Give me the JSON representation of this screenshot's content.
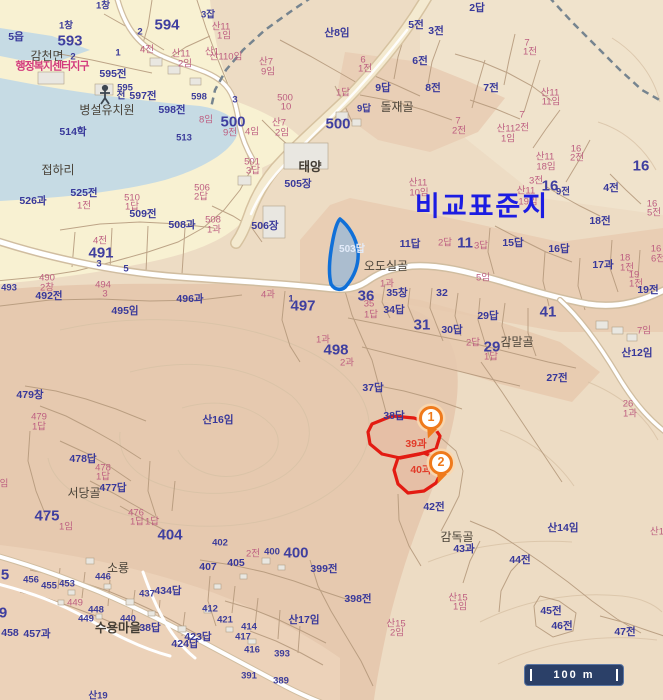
{
  "map": {
    "title_overlay": "비교표준지",
    "scale_bar": {
      "label": "100 m"
    },
    "markers": [
      {
        "label": "1",
        "x": 431,
        "y": 418
      },
      {
        "label": "2",
        "x": 441,
        "y": 463
      }
    ],
    "colors": {
      "highlight_parcel_stroke": "#1070d8",
      "selected_parcel_stroke": "#e31b12",
      "marker_accent": "#ef7a1c",
      "title_blue": "#1c1ce2",
      "urban_fill": "#f8f1d2",
      "water_fill": "#c6dbe4",
      "scalebar_fill": "#2b4068"
    },
    "icons": [
      {
        "name": "kindergarten-person-icon",
        "x": 105,
        "y": 91
      }
    ],
    "labels": [
      [
        "1창",
        103,
        6,
        "n"
      ],
      [
        "3잡",
        208,
        15,
        "n"
      ],
      [
        "594",
        167,
        25,
        "big"
      ],
      [
        "1창",
        66,
        26,
        "n"
      ],
      [
        "2",
        140,
        32,
        "n"
      ],
      [
        "5읍",
        16,
        37,
        "nb"
      ],
      [
        "593",
        70,
        41,
        "big"
      ],
      [
        "4전",
        147,
        50,
        "p"
      ],
      [
        "1",
        118,
        53,
        "n"
      ],
      [
        "산1",
        212,
        52,
        "p"
      ],
      [
        "감천면",
        47,
        56,
        "place"
      ],
      [
        "산11",
        181,
        54,
        "p"
      ],
      [
        "2임",
        185,
        64,
        "p"
      ],
      [
        "2",
        73,
        57,
        "n"
      ],
      [
        "행정복지센터지구",
        52,
        67,
        "adm"
      ],
      [
        "595전",
        113,
        74,
        "nb"
      ],
      [
        "595",
        125,
        88,
        "n"
      ],
      [
        "전",
        121,
        96,
        "n"
      ],
      [
        "597전",
        143,
        96,
        "nb"
      ],
      [
        "598",
        199,
        97,
        "n"
      ],
      [
        "598전",
        172,
        110,
        "nb"
      ],
      [
        "8임",
        206,
        120,
        "p"
      ],
      [
        "병설유치원",
        107,
        110,
        "place"
      ],
      [
        "514학",
        73,
        132,
        "nb"
      ],
      [
        "513",
        184,
        138,
        "n"
      ],
      [
        "접하리",
        58,
        170,
        "place"
      ],
      [
        "산11",
        221,
        27,
        "p"
      ],
      [
        "1임",
        224,
        36,
        "p"
      ],
      [
        "산110임",
        226,
        57,
        "p"
      ],
      [
        "산7",
        266,
        62,
        "p"
      ],
      [
        "9임",
        268,
        72,
        "p"
      ],
      [
        "산8임",
        337,
        33,
        "nb"
      ],
      [
        "5전",
        416,
        25,
        "nb"
      ],
      [
        "3전",
        436,
        31,
        "nb"
      ],
      [
        "6",
        363,
        60,
        "p"
      ],
      [
        "1전",
        365,
        69,
        "p"
      ],
      [
        "6전",
        420,
        61,
        "nb"
      ],
      [
        "8전",
        433,
        88,
        "nb"
      ],
      [
        "9답",
        383,
        88,
        "nb"
      ],
      [
        "1답",
        343,
        93,
        "p"
      ],
      [
        "9답",
        364,
        109,
        "n"
      ],
      [
        "돌재골",
        397,
        107,
        "place"
      ],
      [
        "500",
        285,
        98,
        "p"
      ],
      [
        "10",
        286,
        107,
        "p"
      ],
      [
        "3",
        235,
        100,
        "n"
      ],
      [
        "500",
        233,
        122,
        "big"
      ],
      [
        "9전",
        230,
        133,
        "p"
      ],
      [
        "4임",
        252,
        132,
        "p"
      ],
      [
        "산7",
        279,
        123,
        "p"
      ],
      [
        "2임",
        282,
        133,
        "p"
      ],
      [
        "500",
        338,
        124,
        "big"
      ],
      [
        "2답",
        477,
        8,
        "nb"
      ],
      [
        "7",
        527,
        43,
        "p"
      ],
      [
        "1전",
        530,
        52,
        "p"
      ],
      [
        "7전",
        491,
        88,
        "nb"
      ],
      [
        "산11",
        550,
        93,
        "p"
      ],
      [
        "11임",
        551,
        102,
        "p"
      ],
      [
        "7",
        458,
        121,
        "p"
      ],
      [
        "2전",
        459,
        131,
        "p"
      ],
      [
        "7",
        522,
        115,
        "p"
      ],
      [
        "2전",
        522,
        128,
        "p"
      ],
      [
        "산11",
        506,
        129,
        "p"
      ],
      [
        "1임",
        508,
        139,
        "p"
      ],
      [
        "16",
        576,
        149,
        "p"
      ],
      [
        "2전",
        577,
        158,
        "p"
      ],
      [
        "산11",
        545,
        157,
        "p"
      ],
      [
        "18임",
        546,
        167,
        "p"
      ],
      [
        "16",
        641,
        166,
        "big"
      ],
      [
        "3전",
        536,
        181,
        "p"
      ],
      [
        "16",
        550,
        186,
        "big"
      ],
      [
        "9전",
        563,
        192,
        "n"
      ],
      [
        "4전",
        611,
        188,
        "nb"
      ],
      [
        "산11",
        526,
        191,
        "p"
      ],
      [
        "19임",
        528,
        202,
        "p"
      ],
      [
        "16",
        652,
        204,
        "p"
      ],
      [
        "5전",
        654,
        213,
        "p"
      ],
      [
        "18전",
        600,
        221,
        "nb"
      ],
      [
        "501",
        252,
        162,
        "p"
      ],
      [
        "3답",
        253,
        171,
        "p"
      ],
      [
        "태양",
        310,
        167,
        "placeb"
      ],
      [
        "505장",
        298,
        184,
        "nb"
      ],
      [
        "산11",
        418,
        183,
        "p"
      ],
      [
        "10임",
        419,
        193,
        "p"
      ],
      [
        "506장",
        265,
        226,
        "nb"
      ],
      [
        "503답",
        352,
        250,
        "hl"
      ],
      [
        "11답",
        410,
        244,
        "nb"
      ],
      [
        "2답",
        445,
        243,
        "p"
      ],
      [
        "11",
        465,
        243,
        "big"
      ],
      [
        "3답",
        481,
        246,
        "p"
      ],
      [
        "15답",
        513,
        243,
        "nb"
      ],
      [
        "16답",
        559,
        249,
        "nb"
      ],
      [
        "오도실골",
        386,
        266,
        "place"
      ],
      [
        "17과",
        603,
        265,
        "nb"
      ],
      [
        "18",
        625,
        258,
        "p"
      ],
      [
        "1전",
        627,
        268,
        "p"
      ],
      [
        "19",
        634,
        275,
        "p"
      ],
      [
        "1전",
        636,
        284,
        "p"
      ],
      [
        "16",
        656,
        249,
        "p"
      ],
      [
        "6전",
        658,
        259,
        "p"
      ],
      [
        "19전",
        648,
        290,
        "nb"
      ],
      [
        "5임",
        483,
        278,
        "p"
      ],
      [
        "36",
        366,
        296,
        "big"
      ],
      [
        "1과",
        387,
        284,
        "p"
      ],
      [
        "35창",
        397,
        293,
        "nb"
      ],
      [
        "32",
        442,
        293,
        "nb"
      ],
      [
        "35",
        369,
        304,
        "p"
      ],
      [
        "1답",
        371,
        315,
        "p"
      ],
      [
        "34답",
        394,
        310,
        "nb"
      ],
      [
        "31",
        422,
        325,
        "big"
      ],
      [
        "30답",
        452,
        330,
        "nb"
      ],
      [
        "29답",
        488,
        316,
        "nb"
      ],
      [
        "2답",
        473,
        343,
        "p"
      ],
      [
        "29",
        492,
        347,
        "big"
      ],
      [
        "1답",
        491,
        357,
        "p"
      ],
      [
        "감말골",
        517,
        342,
        "place"
      ],
      [
        "41",
        548,
        312,
        "big"
      ],
      [
        "27전",
        557,
        378,
        "nb"
      ],
      [
        "7임",
        644,
        331,
        "p"
      ],
      [
        "산12임",
        637,
        353,
        "nb"
      ],
      [
        "26",
        628,
        404,
        "p"
      ],
      [
        "1과",
        630,
        414,
        "p"
      ],
      [
        "526과",
        33,
        201,
        "nb"
      ],
      [
        "525전",
        84,
        193,
        "nb"
      ],
      [
        "1전",
        84,
        206,
        "p"
      ],
      [
        "510",
        132,
        198,
        "p"
      ],
      [
        "1답",
        132,
        207,
        "p"
      ],
      [
        "509전",
        143,
        214,
        "nb"
      ],
      [
        "508과",
        182,
        225,
        "nb"
      ],
      [
        "508",
        213,
        220,
        "p"
      ],
      [
        "1과",
        214,
        230,
        "p"
      ],
      [
        "506",
        202,
        188,
        "p"
      ],
      [
        "2답",
        201,
        197,
        "p"
      ],
      [
        "4전",
        100,
        241,
        "p"
      ],
      [
        "491",
        101,
        253,
        "big"
      ],
      [
        "3",
        99,
        264,
        "n"
      ],
      [
        "5",
        126,
        269,
        "n"
      ],
      [
        "490",
        47,
        278,
        "p"
      ],
      [
        "2창",
        47,
        288,
        "p"
      ],
      [
        "492전",
        49,
        296,
        "nb"
      ],
      [
        "493",
        9,
        288,
        "n"
      ],
      [
        "494",
        103,
        285,
        "p"
      ],
      [
        "3",
        105,
        294,
        "p"
      ],
      [
        "495임",
        125,
        311,
        "nb"
      ],
      [
        "496과",
        190,
        299,
        "nb"
      ],
      [
        "4과",
        268,
        295,
        "p"
      ],
      [
        "1",
        291,
        299,
        "n"
      ],
      [
        "497",
        303,
        306,
        "big"
      ],
      [
        "1과",
        323,
        340,
        "p"
      ],
      [
        "498",
        336,
        350,
        "big"
      ],
      [
        "2과",
        347,
        363,
        "p"
      ],
      [
        "산16임",
        218,
        420,
        "nb"
      ],
      [
        "479창",
        30,
        395,
        "nb"
      ],
      [
        "479",
        39,
        417,
        "p"
      ],
      [
        "1답",
        39,
        427,
        "p"
      ],
      [
        "478답",
        83,
        459,
        "nb"
      ],
      [
        "478",
        103,
        468,
        "p"
      ],
      [
        "1답",
        103,
        477,
        "p"
      ],
      [
        "477답",
        113,
        488,
        "nb"
      ],
      [
        "서당골",
        84,
        493,
        "place"
      ],
      [
        "임",
        4,
        484,
        "p"
      ],
      [
        "475",
        47,
        516,
        "big"
      ],
      [
        "1임",
        66,
        527,
        "p"
      ],
      [
        "476",
        136,
        513,
        "p"
      ],
      [
        "1답",
        137,
        522,
        "p"
      ],
      [
        "1답",
        152,
        522,
        "p"
      ],
      [
        "404",
        170,
        535,
        "big"
      ],
      [
        "37답",
        373,
        388,
        "nb"
      ],
      [
        "38답",
        394,
        416,
        "nb"
      ],
      [
        "39과",
        416,
        444,
        "red"
      ],
      [
        "40과",
        421,
        470,
        "red"
      ],
      [
        "42전",
        434,
        507,
        "nb"
      ],
      [
        "감독골",
        457,
        537,
        "place"
      ],
      [
        "43과",
        464,
        549,
        "nb"
      ],
      [
        "44전",
        520,
        560,
        "nb"
      ],
      [
        "산14임",
        563,
        528,
        "nb"
      ],
      [
        "산1",
        657,
        532,
        "p"
      ],
      [
        "산15",
        458,
        598,
        "p"
      ],
      [
        "1임",
        460,
        607,
        "p"
      ],
      [
        "45전",
        551,
        611,
        "nb"
      ],
      [
        "46전",
        562,
        626,
        "nb"
      ],
      [
        "47전",
        625,
        632,
        "nb"
      ],
      [
        "402",
        220,
        543,
        "n"
      ],
      [
        "2전",
        253,
        554,
        "p"
      ],
      [
        "400",
        272,
        552,
        "n"
      ],
      [
        "400",
        296,
        553,
        "big"
      ],
      [
        "399전",
        324,
        569,
        "nb"
      ],
      [
        "405",
        236,
        563,
        "nb"
      ],
      [
        "407",
        208,
        567,
        "nb"
      ],
      [
        "소룡",
        118,
        568,
        "place"
      ],
      [
        "446",
        103,
        577,
        "n"
      ],
      [
        "456",
        31,
        580,
        "n"
      ],
      [
        "455",
        49,
        586,
        "n"
      ],
      [
        "453",
        67,
        584,
        "n"
      ],
      [
        "5",
        5,
        575,
        "big"
      ],
      [
        "449",
        75,
        603,
        "p"
      ],
      [
        "448",
        96,
        610,
        "n"
      ],
      [
        "449",
        86,
        619,
        "n"
      ],
      [
        "437",
        147,
        594,
        "n"
      ],
      [
        "434답",
        168,
        591,
        "nb"
      ],
      [
        "440",
        128,
        619,
        "n"
      ],
      [
        "수용마을",
        118,
        628,
        "placeb"
      ],
      [
        "38답",
        150,
        628,
        "nb"
      ],
      [
        "9",
        3,
        613,
        "big"
      ],
      [
        "458",
        10,
        633,
        "nb"
      ],
      [
        "457과",
        37,
        634,
        "nb"
      ],
      [
        "424답",
        185,
        644,
        "nb"
      ],
      [
        "423답",
        198,
        637,
        "nb"
      ],
      [
        "412",
        210,
        609,
        "n"
      ],
      [
        "421",
        225,
        620,
        "n"
      ],
      [
        "414",
        249,
        627,
        "n"
      ],
      [
        "417",
        243,
        637,
        "n"
      ],
      [
        "416",
        252,
        650,
        "n"
      ],
      [
        "393",
        282,
        654,
        "n"
      ],
      [
        "391",
        249,
        676,
        "n"
      ],
      [
        "389",
        281,
        681,
        "n"
      ],
      [
        "398전",
        358,
        599,
        "nb"
      ],
      [
        "산17임",
        304,
        620,
        "nb"
      ],
      [
        "산15",
        396,
        624,
        "p"
      ],
      [
        "2임",
        397,
        633,
        "p"
      ],
      [
        "산19",
        98,
        696,
        "n"
      ]
    ]
  }
}
